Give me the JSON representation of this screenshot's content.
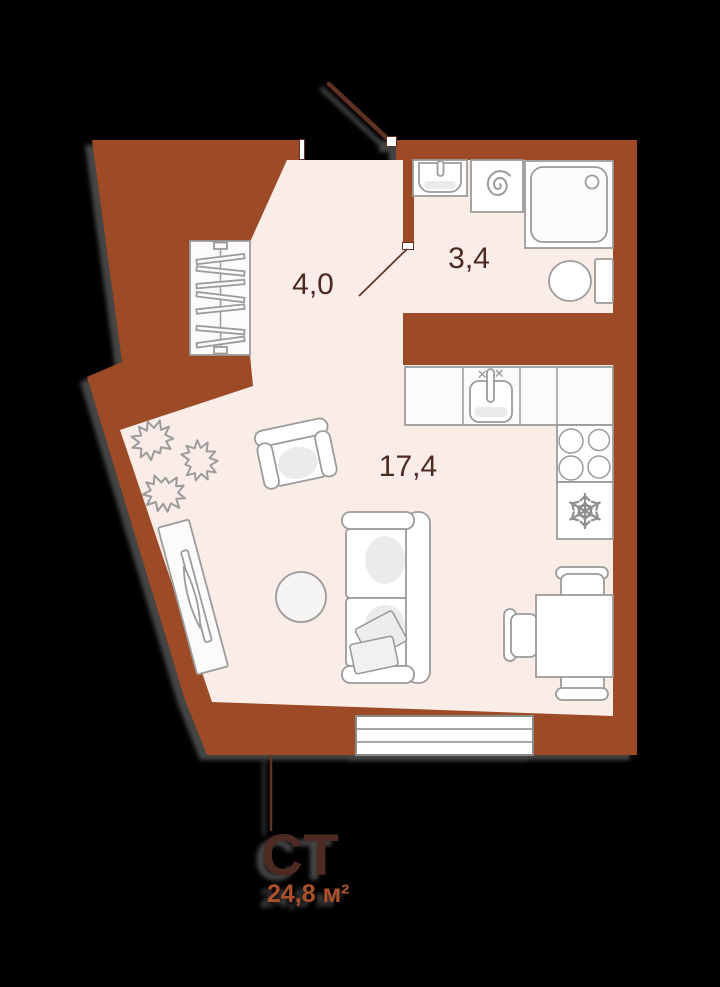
{
  "plan": {
    "unit_type_label": "СТ",
    "unit_area_label": "24,8 м²",
    "rooms": [
      {
        "id": "hallway",
        "area_label": "4,0"
      },
      {
        "id": "bathroom",
        "area_label": "3,4"
      },
      {
        "id": "living-kitchen",
        "area_label": "17,4"
      }
    ],
    "colors": {
      "background": "#000000",
      "wall": "#9D4A26",
      "floor": "#FAEDE8",
      "furniture_stroke": "#9B9B9B",
      "room_label_text": "#4D2B22",
      "unit_label_text": "#4D2B22",
      "area_label_text": "#AC512B",
      "door": "#5E3123"
    },
    "furniture": [
      {
        "name": "wardrobe"
      },
      {
        "name": "plant"
      },
      {
        "name": "tv-stand"
      },
      {
        "name": "armchair"
      },
      {
        "name": "pouf"
      },
      {
        "name": "sofa"
      },
      {
        "name": "dining-table"
      },
      {
        "name": "chair"
      },
      {
        "name": "fridge"
      },
      {
        "name": "stove"
      },
      {
        "name": "kitchen-sink"
      },
      {
        "name": "washing-machine"
      },
      {
        "name": "shower"
      },
      {
        "name": "bathroom-sink"
      },
      {
        "name": "toilet"
      },
      {
        "name": "window"
      },
      {
        "name": "entrance-door"
      },
      {
        "name": "bathroom-door"
      }
    ]
  }
}
